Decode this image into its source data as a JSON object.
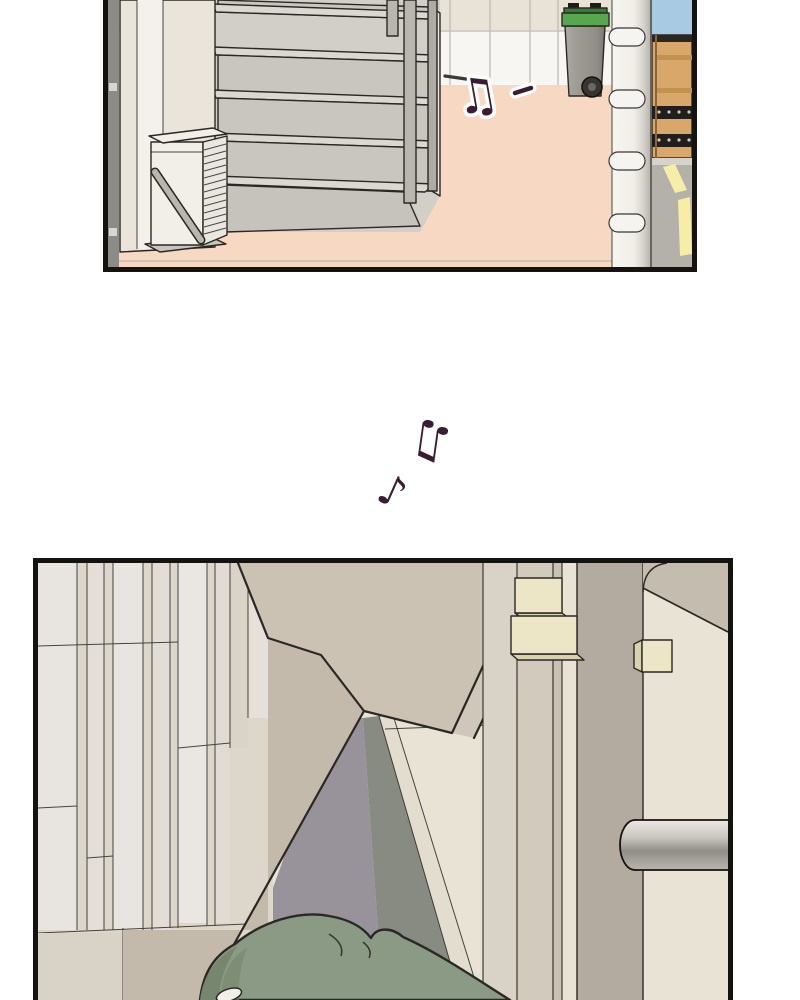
{
  "palette": {
    "page_bg": "#ffffff",
    "panel_border": "#15130f",
    "wall_beige": "#e8e2d7",
    "wall_white_band": "#f8f6f2",
    "floor_peach": "#f7d8c3",
    "step_tread": "#dbd8d2",
    "step_riser": "#c9c6bf",
    "rail_gray": "#b9b6b0",
    "ac_white": "#f2efe8",
    "bin_green": "#56a74e",
    "bin_gray": "#9c9993",
    "pole_white": "#f6f4f0",
    "sky_blue": "#a9cae3",
    "gate_tan": "#d9a76a",
    "road_gray": "#b4b1ab",
    "road_stripe_yellow": "#f6eea6",
    "note_purple": "#3a1c33",
    "panel_strip_light": "#e8e5e0",
    "panel_strip_beige": "#ddd7cb",
    "stair_taupe_light": "#cbc2b4",
    "stair_taupe": "#c3baac",
    "underwall_purple": "#98929b",
    "underwall_green": "#878b81",
    "door_cream": "#e9e3d6",
    "block_cream": "#ece5c6",
    "hood_green": "#8a9a84",
    "hood_green_dark": "#76866f"
  },
  "notes": {
    "beamed_note": "♫",
    "single_note": "♪"
  }
}
